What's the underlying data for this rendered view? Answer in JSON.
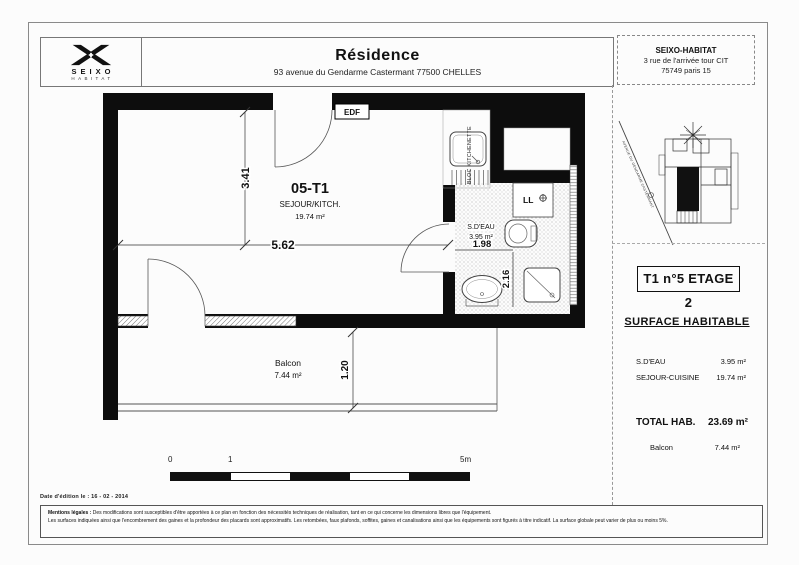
{
  "header": {
    "logo": {
      "brand_top": "SEIXO",
      "brand_bottom": "HABITAT"
    },
    "residence_title": "Résidence",
    "residence_address": "93 avenue du Gendarme Castermant 77500 CHELLES",
    "company_name": "SEIXO-HABITAT",
    "company_address1": "3 rue de l'arrivée tour CIT",
    "company_address2": "75749 paris 15"
  },
  "plan": {
    "unit_label": "05-T1",
    "room_label": "SEJOUR/KITCH.",
    "room_area": "19.74 m²",
    "bath_label": "S.D'EAU",
    "bath_area": "3.95 m²",
    "kitchen_label": "BLOC KITCHENETTE",
    "edf_label": "EDF",
    "washer_label": "LL",
    "balcony_label": "Balcon",
    "balcony_area": "7.44 m²",
    "dim_width": "5.62",
    "dim_height": "3.41",
    "dim_bath_width": "1.98",
    "dim_bath_height": "2.16",
    "dim_balcony_depth": "1.20"
  },
  "sidebar": {
    "street_label": "AVENUE DU GENDARME CASTERMANT",
    "unit_box_label": "T1 n°5 ETAGE 2",
    "surface_title": "SURFACE HABITABLE",
    "rows": [
      {
        "label": "S.D'EAU",
        "value": "3.95 m²"
      },
      {
        "label": "SEJOUR-CUISINE",
        "value": "19.74 m²"
      }
    ],
    "total_label": "TOTAL HAB.",
    "total_value": "23.69 m²",
    "balcony_label": "Balcon",
    "balcony_value": "7.44 m²"
  },
  "scalebar": {
    "t0": "0",
    "t1": "1",
    "t5": "5m"
  },
  "footer": {
    "date_line": "Date d'édition le : 16 - 02 - 2014",
    "legal_label": "Mentions légales :",
    "legal_line1": "Des modifications sont susceptibles d'être apportées à ce plan en fonction des nécessités techniques de réalisation, tant en ce qui concerne les dimensions libres que l'équipement.",
    "legal_line2": "Les surfaces indiquées ainsi que l'encombrement des gaines et la profondeur des placards sont approximatifs. Les retombées, faux plafonds, soffites, gaines et canalisations ainsi que les équipements sont figurés à titre indicatif. La surface globale peut varier de plus ou moins 5%."
  },
  "colors": {
    "wall": "#0d0d0d",
    "line": "#444444",
    "paper": "#fcfcfc"
  }
}
